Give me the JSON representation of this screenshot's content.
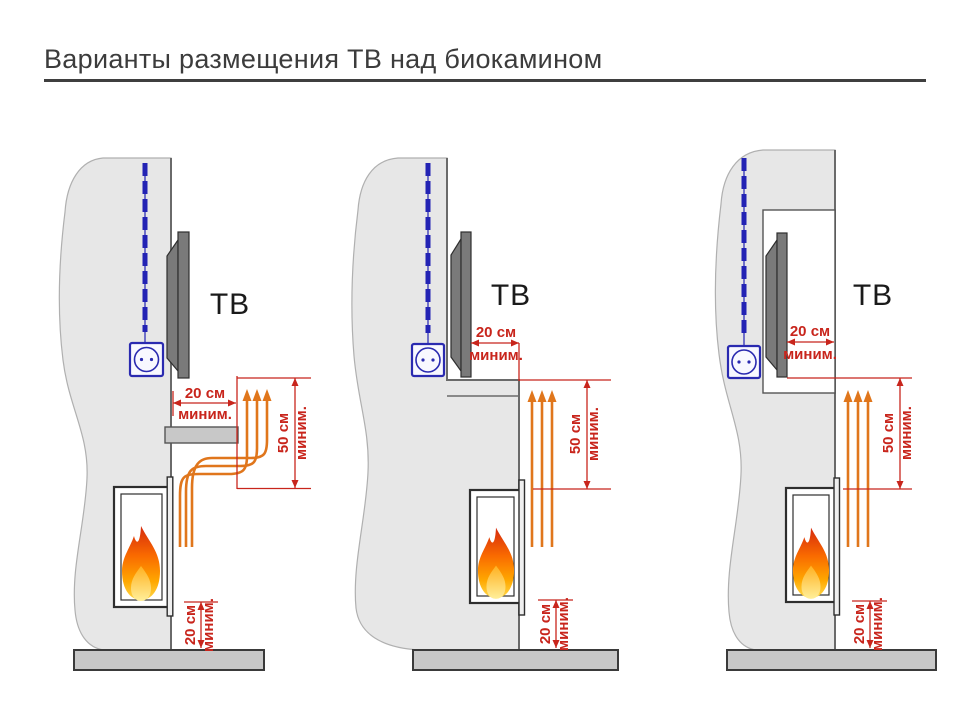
{
  "title": "Варианты размещения ТВ над биокамином",
  "diagrams": [
    {
      "tv_label": "ТВ",
      "tv_clearance": {
        "value": "20 см",
        "qualifier": "миним."
      },
      "flue_clearance": {
        "value": "50 см",
        "qualifier": "миним."
      },
      "floor_clearance": {
        "value": "20 см",
        "qualifier": "миним."
      }
    },
    {
      "tv_label": "ТВ",
      "tv_clearance": {
        "value": "20 см",
        "qualifier": "миним."
      },
      "flue_clearance": {
        "value": "50 см",
        "qualifier": "миним."
      },
      "floor_clearance": {
        "value": "20 см",
        "qualifier": "миним."
      }
    },
    {
      "tv_label": "ТВ",
      "tv_clearance": {
        "value": "20 см",
        "qualifier": "миним."
      },
      "flue_clearance": {
        "value": "50 см",
        "qualifier": "миним."
      },
      "floor_clearance": {
        "value": "20 см",
        "qualifier": "миним."
      }
    }
  ],
  "colors": {
    "dimension_red": "#c8251c",
    "heat_arrow_orange": "#e0761c",
    "cable_blue": "#2323b4",
    "wall_gray": "#e7e7e7",
    "floor_gray": "#c8c8c8",
    "tv_gray": "#7a7a7a"
  }
}
